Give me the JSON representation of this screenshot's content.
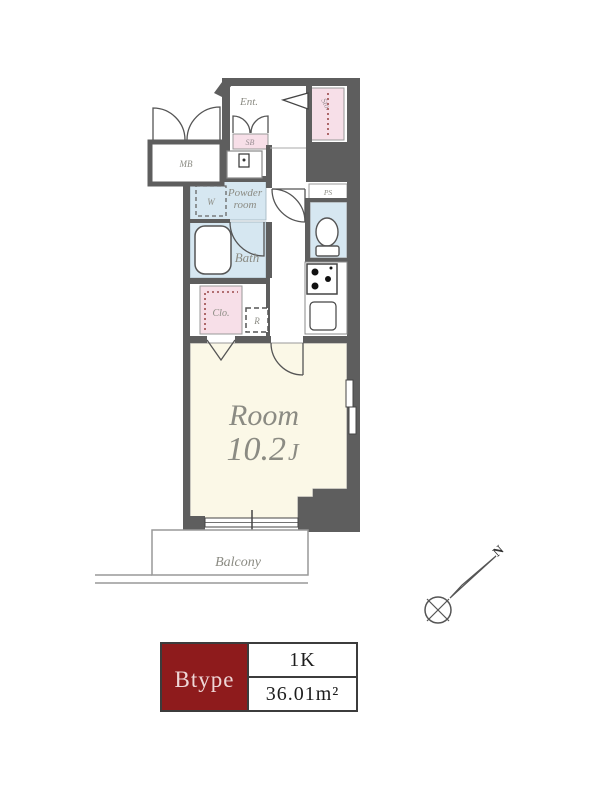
{
  "plan": {
    "labels": {
      "entrance": "Ent.",
      "shoe_box": "SB",
      "meter_box": "MB",
      "storage": "Sto.",
      "pipe_space": "PS",
      "powder_room_1": "Powder",
      "powder_room_2": "room",
      "washer": "W",
      "bath": "Bath",
      "closet": "Clo.",
      "refrigerator": "R",
      "room": "Room",
      "room_size": "10.2",
      "room_size_suffix": "J",
      "balcony": "Balcony",
      "north": "N"
    },
    "colors": {
      "wall": "#5e5e5e",
      "water_blue": "#d6e7f1",
      "storage_pink": "#f7dfe8",
      "room_cream": "#fbf8e7",
      "label_gray": "#8b8b83",
      "legend_red": "#8e1b1c"
    }
  },
  "legend": {
    "type": "Btype",
    "layout": "1K",
    "area": "36.01m²"
  }
}
